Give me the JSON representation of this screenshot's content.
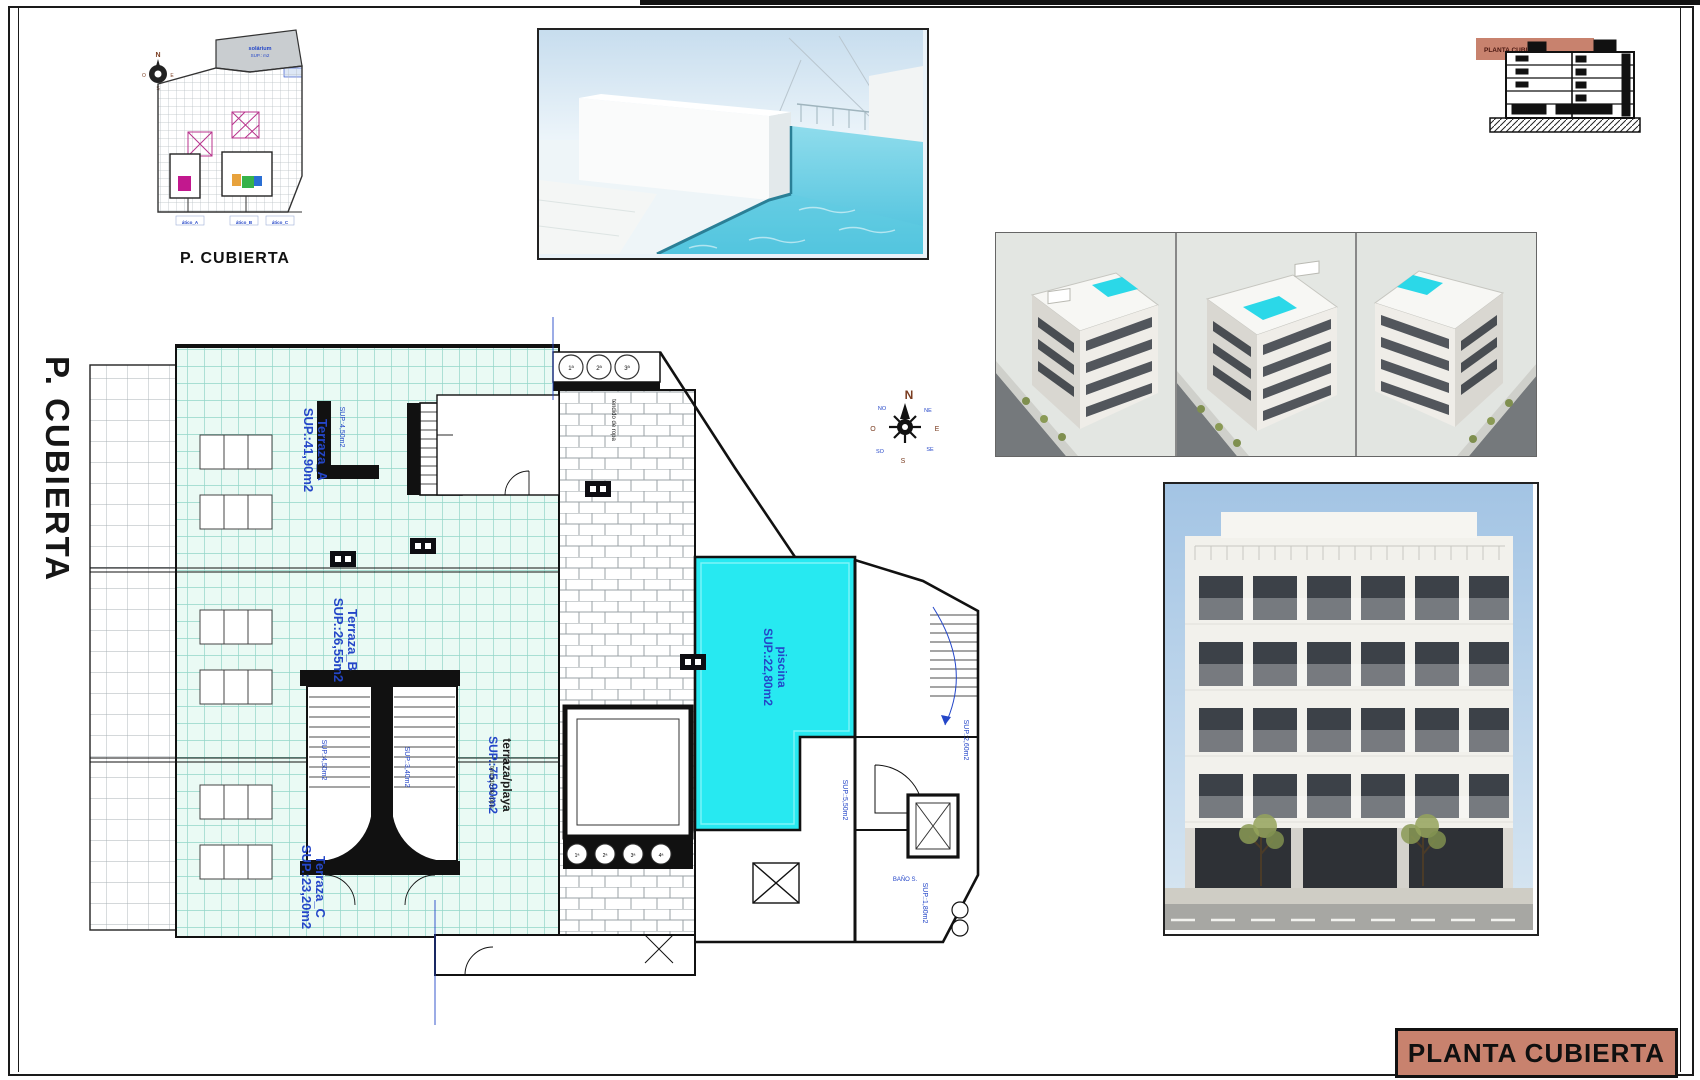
{
  "sheet": {
    "side_label": "P. CUBIERTA",
    "title_block": "PLANTA CUBIERTA",
    "colors": {
      "salmon": "#c8826e",
      "pool_cyan": "#27e9f1",
      "label_blue": "#2446c8",
      "mint": "#e7f8f2"
    }
  },
  "site_plan": {
    "caption": "P. CUBIERTA",
    "area_top": "solárium",
    "area_top_sup": "SUP.: m2",
    "tags": [
      "ático_A",
      "ático_B",
      "ático_C"
    ]
  },
  "section_thumb": {
    "banner": "PLANTA CUBIERTA"
  },
  "plan": {
    "terraza_a": {
      "name": "Terraza_A",
      "sup": "SUP.:41,90m2"
    },
    "terraza_b": {
      "name": "Terraza_B",
      "sup": "SUP.:26,55m2"
    },
    "terraza_c": {
      "name": "Terraza_C",
      "sup": "SUP.:23,20m2"
    },
    "terraza_playa": {
      "name": "terraza/playa",
      "sup": "SUP.:75,90m2"
    },
    "piscina": {
      "name": "piscina",
      "sup": "SUP.:22,80m2"
    },
    "tendido_1": "tendido de ropa",
    "tendido_2": "tendido de ropa",
    "sup_stair_top": "SUP.:4,50m2",
    "sup_core_left": "SUP.:4,50m2",
    "sup_core_right": "SUP.:3,40m2",
    "sup_right_1": "SUP.:2,60m2",
    "sup_right_2": "SUP.:5,50m2",
    "sup_bath": "SUP.:1,80m2",
    "bath": "BAÑO S.",
    "skylights": [
      "1ª",
      "2ª",
      "3ª"
    ],
    "vents": [
      "1ª",
      "2ª",
      "3ª",
      "4ª"
    ],
    "compass": {
      "n": "N",
      "e": "E",
      "s": "S",
      "o": "O",
      "ne": "NE",
      "no": "NO",
      "se": "SE",
      "so": "SO"
    }
  }
}
